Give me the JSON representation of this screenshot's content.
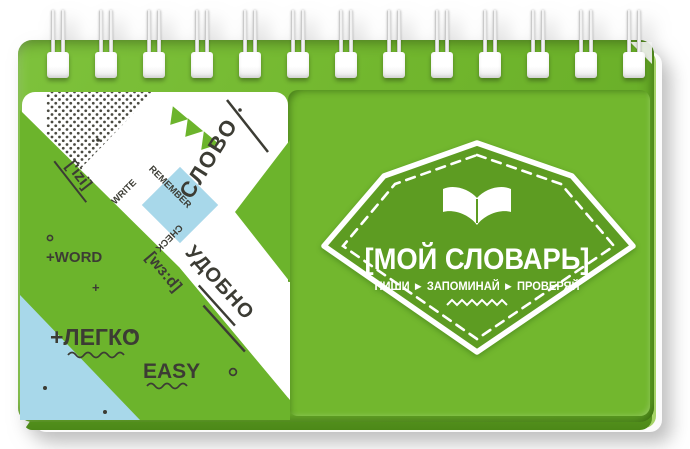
{
  "badge": {
    "title": "[МОЙ СЛОВАРЬ]",
    "subtitle": "ПИШИ ► ЗАПОМИНАЙ ► ПРОВЕРЯЙ",
    "icon": "open-book-icon"
  },
  "left_panel": {
    "slovo": "СЛОВО",
    "udobno": "УДОБНО",
    "legko": "+ЛЕГКО",
    "easy": "EASY",
    "word": "+WORD",
    "word_phonetic": "[wз:d]",
    "easy_phonetic": "['izi]",
    "write": "WRITE",
    "remember": "REMEMBER",
    "check": "CHECK"
  },
  "cover": {
    "spiral_count": 13,
    "colors": {
      "cover_green": "#72b72e",
      "badge_green": "#5d9c22",
      "accent_blue": "#a8d8ea",
      "ink": "#3c3c34",
      "white": "#ffffff"
    }
  }
}
